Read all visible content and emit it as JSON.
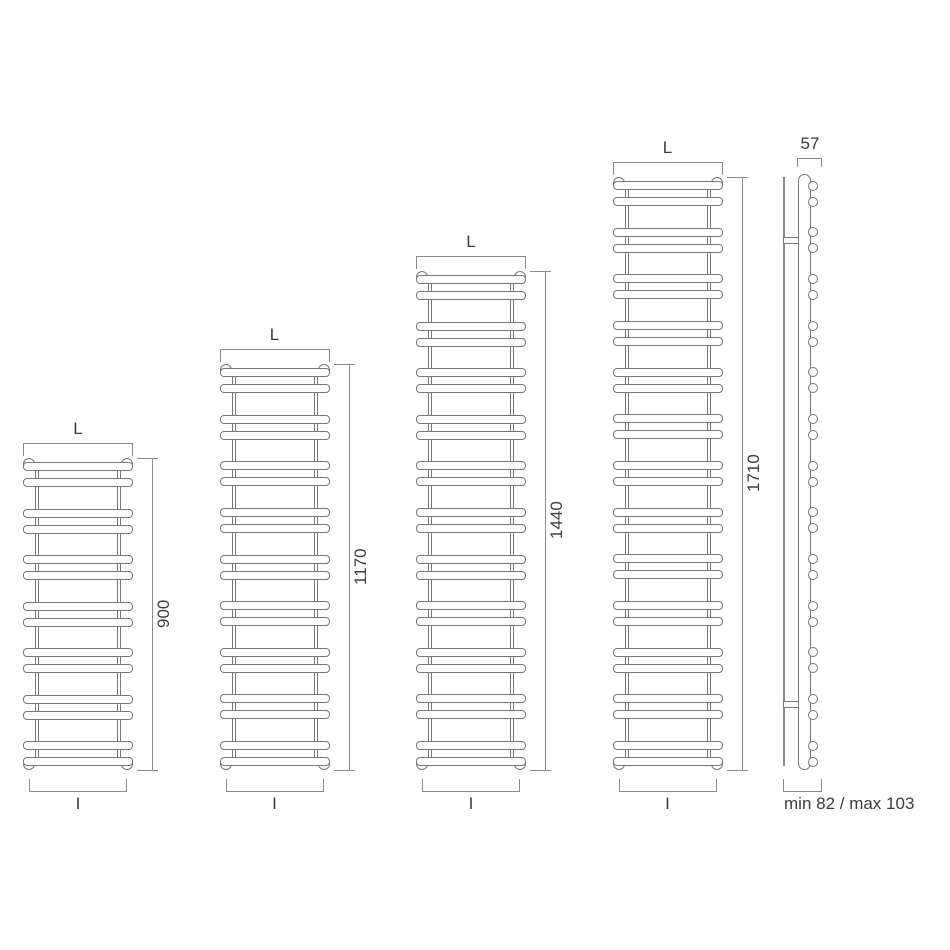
{
  "diagram": {
    "title": "towel-radiator-dimension-drawing",
    "width_label": "L",
    "fixing_centres_label": "I",
    "radiators": [
      {
        "height_label": "900",
        "height_mm": 900,
        "bar_pairs": 7,
        "bars": 14
      },
      {
        "height_label": "1170",
        "height_mm": 1170,
        "bar_pairs": 9,
        "bars": 18
      },
      {
        "height_label": "1440",
        "height_mm": 1440,
        "bar_pairs": 11,
        "bars": 22
      },
      {
        "height_label": "1710",
        "height_mm": 1710,
        "bar_pairs": 13,
        "bars": 26
      }
    ],
    "side_view": {
      "depth_label": "57",
      "wall_distance_label": "min 82 / max 103",
      "bar_pairs": 13
    },
    "colors": {
      "outline": "#777777",
      "dimension_line": "#8c8c8c",
      "text": "#3c3c3c",
      "background": "#ffffff"
    }
  }
}
